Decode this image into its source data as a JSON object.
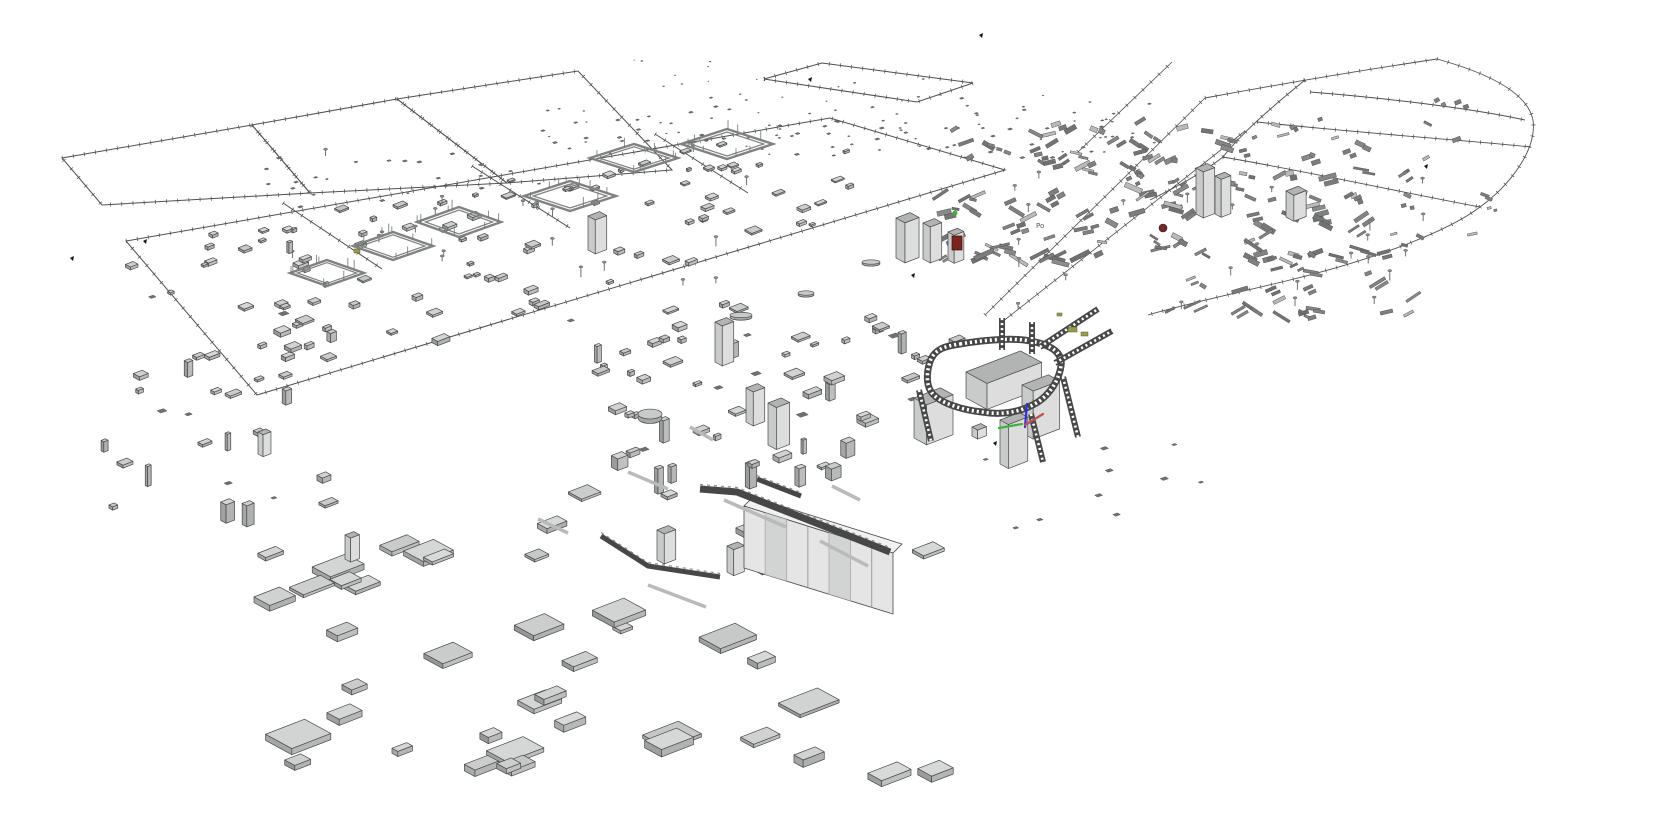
{
  "meta": {
    "app": "3d-model-viewport"
  },
  "palette": {
    "background": "#ffffff",
    "outline": "#4a4a4a",
    "wire": "#4f4f4f",
    "slab_top": "#cfd1d0",
    "slab_right": "#b7b9b8",
    "slab_left": "#9fa1a0",
    "tiny": "#6f7271",
    "bar": "#7b7e7d",
    "bar_light": "#b9bbba",
    "track": "#474747",
    "track_rung": "#ffffff",
    "bldg_top": "#b2b4b3",
    "bldg_right": "#dcdddc",
    "bldg_left": "#c9cbca",
    "cabinet_face": "#e4e5e4",
    "cabinet_shade": "#cfd1d0",
    "pit": "#7f8281",
    "post": "#6f7170",
    "accent_red": "#7c241f",
    "accent_darkred": "#6e2a28",
    "accent_olive": "#99994f",
    "accent_green": "#3fae3f",
    "axis_x": "#c05050",
    "axis_y": "#3cb43c",
    "axis_z": "#2f2fd2",
    "black": "#141414"
  },
  "scene": {
    "seed": 42,
    "width": 1660,
    "height": 840,
    "planes": [
      {
        "name": "upper-band-left",
        "points": [
          [
            62,
            158
          ],
          [
            252,
            125
          ],
          [
            310,
            193
          ],
          [
            102,
            205
          ]
        ],
        "closed": true
      },
      {
        "name": "upper-band-mid",
        "points": [
          [
            252,
            125
          ],
          [
            397,
            99
          ],
          [
            507,
            183
          ],
          [
            310,
            193
          ]
        ],
        "closed": true
      },
      {
        "name": "upper-band-right",
        "points": [
          [
            397,
            99
          ],
          [
            578,
            71
          ],
          [
            672,
            170
          ],
          [
            507,
            183
          ]
        ],
        "closed": true
      },
      {
        "name": "upper-slab",
        "points": [
          [
            764,
            79
          ],
          [
            822,
            63
          ],
          [
            973,
            83
          ],
          [
            917,
            102
          ]
        ],
        "closed": true
      },
      {
        "name": "main-plot",
        "points": [
          [
            126,
            241
          ],
          [
            830,
            118
          ],
          [
            1005,
            170
          ],
          [
            257,
            395
          ]
        ],
        "closed": true
      },
      {
        "name": "plot-div-1",
        "points": [
          [
            283,
            203
          ],
          [
            382,
            269
          ]
        ],
        "closed": false
      },
      {
        "name": "plot-div-2",
        "points": [
          [
            472,
            166
          ],
          [
            570,
            228
          ]
        ],
        "closed": false
      },
      {
        "name": "plot-div-3",
        "points": [
          [
            655,
            134
          ],
          [
            748,
            193
          ]
        ],
        "closed": false
      }
    ],
    "boundary_lines": [
      [
        [
          985,
          315
        ],
        [
          1205,
          98
        ]
      ],
      [
        [
          1002,
          322
        ],
        [
          1245,
          131
        ]
      ],
      [
        [
          1078,
          152
        ],
        [
          1172,
          62
        ]
      ]
    ],
    "curve_paths": [
      "M1205,98 C1270,86 1350,72 1437,59",
      "M1437,59 C1495,75 1528,95 1533,120 C1537,150 1510,185 1480,207 C1450,230 1380,258 1290,280 C1245,291 1190,303 1148,315",
      "M1310,92 C1385,98 1470,108 1525,120",
      "M1257,122 C1350,132 1460,140 1531,147",
      "M1223,157 C1310,172 1400,192 1480,207",
      "M1305,80 C1268,110 1240,135 1223,157 C1200,175 1172,189 1150,200"
    ],
    "pits": [
      [
        327,
        273,
        74,
        26
      ],
      [
        393,
        246,
        80,
        28
      ],
      [
        459,
        222,
        84,
        30
      ],
      [
        570,
        196,
        92,
        30
      ],
      [
        634,
        158,
        88,
        28
      ],
      [
        727,
        144,
        92,
        30
      ]
    ],
    "clusters": [
      {
        "name": "far-band-a",
        "kind": "tiny",
        "rect": [
          540,
          108,
          160,
          48
        ],
        "count": 26,
        "size": [
          2.5,
          7
        ]
      },
      {
        "name": "far-band-b",
        "kind": "tiny",
        "rect": [
          700,
          92,
          460,
          66
        ],
        "count": 95,
        "size": [
          2.5,
          7
        ]
      },
      {
        "name": "top-specks",
        "kind": "tiny",
        "rect": [
          595,
          58,
          330,
          36
        ],
        "count": 12,
        "size": [
          2,
          5
        ]
      },
      {
        "name": "upper-mid",
        "kind": "tiny",
        "rect": [
          250,
          150,
          300,
          58
        ],
        "count": 24,
        "size": [
          3,
          7
        ]
      },
      {
        "name": "curve-specks",
        "kind": "bars",
        "rect": [
          1310,
          100,
          200,
          140
        ],
        "count": 14,
        "len": [
          6,
          16
        ],
        "th": [
          2,
          4
        ]
      },
      {
        "name": "right-dense",
        "kind": "bars",
        "rect": [
          935,
          118,
          430,
          145
        ],
        "count": 135,
        "len": [
          8,
          30
        ],
        "th": [
          2,
          5
        ]
      },
      {
        "name": "posts",
        "kind": "post",
        "rect": [
          1000,
          175,
          430,
          145
        ],
        "count": 26
      },
      {
        "name": "midplane",
        "kind": "slab",
        "quad": [
          [
            150,
            238
          ],
          [
            800,
            130
          ],
          [
            950,
            185
          ],
          [
            300,
            382
          ]
        ],
        "count": 88,
        "size": [
          6,
          17
        ]
      },
      {
        "name": "pit-posts",
        "kind": "post",
        "rect": [
          290,
          150,
          500,
          140
        ],
        "count": 20
      },
      {
        "name": "left-edge",
        "kind": "mix",
        "rect": [
          95,
          235,
          240,
          285
        ],
        "count": 40,
        "size": [
          5,
          14
        ]
      },
      {
        "name": "right-tail",
        "kind": "bars",
        "rect": [
          1155,
          258,
          260,
          62
        ],
        "count": 22,
        "len": [
          8,
          24
        ],
        "th": [
          2,
          4
        ]
      },
      {
        "name": "curve-lower",
        "kind": "bars",
        "rect": [
          1270,
          230,
          160,
          45
        ],
        "count": 8,
        "len": [
          6,
          18
        ],
        "th": [
          2,
          4
        ]
      },
      {
        "name": "center-mid",
        "kind": "mix",
        "rect": [
          560,
          300,
          395,
          170
        ],
        "count": 62,
        "size": [
          5,
          16
        ]
      },
      {
        "name": "right-bottom",
        "kind": "tiny",
        "rect": [
          950,
          430,
          300,
          130
        ],
        "count": 10,
        "size": [
          3,
          6
        ]
      },
      {
        "name": "bottom-sparse",
        "kind": "slab",
        "rect": [
          245,
          480,
          700,
          295
        ],
        "count": 46,
        "size": [
          10,
          32
        ]
      }
    ],
    "domes": [
      [
        650,
        414,
        12,
        9
      ],
      [
        741,
        315,
        11,
        5
      ],
      [
        806,
        293,
        8,
        4
      ],
      [
        871,
        262,
        9,
        4
      ]
    ],
    "towers": [
      [
        896,
        218,
        16,
        40
      ],
      [
        923,
        223,
        13,
        36
      ],
      [
        948,
        232,
        11,
        28
      ],
      [
        588,
        216,
        13,
        34
      ],
      [
        715,
        322,
        13,
        40
      ],
      [
        768,
        403,
        15,
        42
      ],
      [
        746,
        388,
        13,
        34
      ],
      [
        1196,
        168,
        13,
        46
      ],
      [
        1215,
        176,
        11,
        38
      ],
      [
        1286,
        191,
        14,
        26
      ],
      [
        657,
        530,
        13,
        30
      ],
      [
        727,
        546,
        12,
        26
      ],
      [
        345,
        535,
        10,
        24
      ],
      [
        258,
        432,
        9,
        22
      ]
    ],
    "buildings": [
      {
        "name": "main-hall",
        "box": [
          966,
          372,
          62,
          30,
          26
        ]
      },
      {
        "name": "right-wing",
        "box": [
          1022,
          385,
          30,
          16,
          48
        ]
      },
      {
        "name": "left-annex",
        "box": [
          914,
          398,
          30,
          18,
          40
        ]
      },
      {
        "name": "south-wall",
        "box": [
          1000,
          420,
          22,
          12,
          44
        ]
      },
      {
        "name": "small-cube",
        "box": [
          972,
          427,
          10,
          8,
          9
        ]
      }
    ],
    "loop": {
      "d": "M 960,344 C 990,339 1016,338 1030,341 C 1052,345 1063,353 1061,366 C 1059,380 1050,394 1038,402 C 1020,413 1000,415 982,412 C 962,410 940,403 932,393 C 925,384 927,369 931,359 C 936,349 945,346 960,344 Z",
      "w": 7
    },
    "ladders": [
      {
        "pts": [
          [
            1040,
            347
          ],
          [
            1098,
            309
          ]
        ],
        "w": 6
      },
      {
        "pts": [
          [
            1055,
            363
          ],
          [
            1112,
            331
          ]
        ],
        "w": 6
      },
      {
        "pts": [
          [
            1002,
            318
          ],
          [
            1002,
            350
          ]
        ],
        "w": 6
      },
      {
        "pts": [
          [
            1032,
            322
          ],
          [
            1032,
            354
          ]
        ],
        "w": 6
      },
      {
        "pts": [
          [
            1063,
            377
          ],
          [
            1078,
            437
          ]
        ],
        "w": 6
      },
      {
        "pts": [
          [
            919,
            390
          ],
          [
            931,
            441
          ]
        ],
        "w": 6
      },
      {
        "pts": [
          [
            1031,
            414
          ],
          [
            1043,
            462
          ]
        ],
        "w": 6
      }
    ],
    "cabinets": {
      "front": [
        [
          744,
          506
        ],
        [
          893,
          553
        ],
        [
          893,
          614
        ],
        [
          744,
          568
        ]
      ],
      "top": [
        [
          744,
          506
        ],
        [
          893,
          553
        ],
        [
          902,
          544
        ],
        [
          753,
          497
        ]
      ],
      "dividers": 6,
      "shaded_panels": [
        1,
        4
      ]
    },
    "conveyors": [
      {
        "name": "main-ramp",
        "pts": [
          [
            700,
            489
          ],
          [
            737,
            492
          ],
          [
            890,
            552
          ]
        ],
        "w": 7
      },
      {
        "name": "short-ramp",
        "pts": [
          [
            757,
            479
          ],
          [
            801,
            496
          ]
        ],
        "w": 5
      },
      {
        "name": "l-rail",
        "pts": [
          [
            601,
            536
          ],
          [
            648,
            566
          ],
          [
            720,
            577
          ]
        ],
        "w": 5
      }
    ],
    "light_bars": [
      [
        724,
        500,
        786,
        527
      ],
      [
        648,
        585,
        706,
        607
      ],
      [
        628,
        472,
        668,
        489
      ],
      [
        538,
        519,
        568,
        533
      ],
      [
        690,
        427,
        713,
        440
      ],
      [
        832,
        486,
        860,
        500
      ],
      [
        820,
        541,
        868,
        566
      ]
    ],
    "accents": {
      "red_box": [
        952,
        236,
        10,
        14
      ],
      "red_ball": [
        1163,
        228,
        4
      ],
      "olive_bits": [
        [
          1068,
          327,
          9,
          5
        ],
        [
          1081,
          332,
          7,
          4
        ],
        [
          1057,
          313,
          5,
          3
        ],
        [
          354,
          249,
          6,
          4
        ]
      ],
      "green_dot": [
        955,
        213,
        2.5
      ]
    },
    "black_marks": [
      [
        70,
        258
      ],
      [
        143,
        241
      ],
      [
        808,
        79
      ],
      [
        911,
        275
      ],
      [
        993,
        443
      ],
      [
        1424,
        166
      ],
      [
        979,
        35
      ]
    ],
    "gizmo": {
      "green": [
        [
          1022,
          424
        ],
        [
          999,
          428
        ]
      ],
      "blue": [
        [
          1025,
          427
        ],
        [
          1027,
          404
        ]
      ],
      "red": [
        [
          1025,
          425
        ],
        [
          1043,
          414
        ]
      ]
    },
    "micro_label": {
      "text": "Po",
      "x": 1036,
      "y": 228
    }
  }
}
